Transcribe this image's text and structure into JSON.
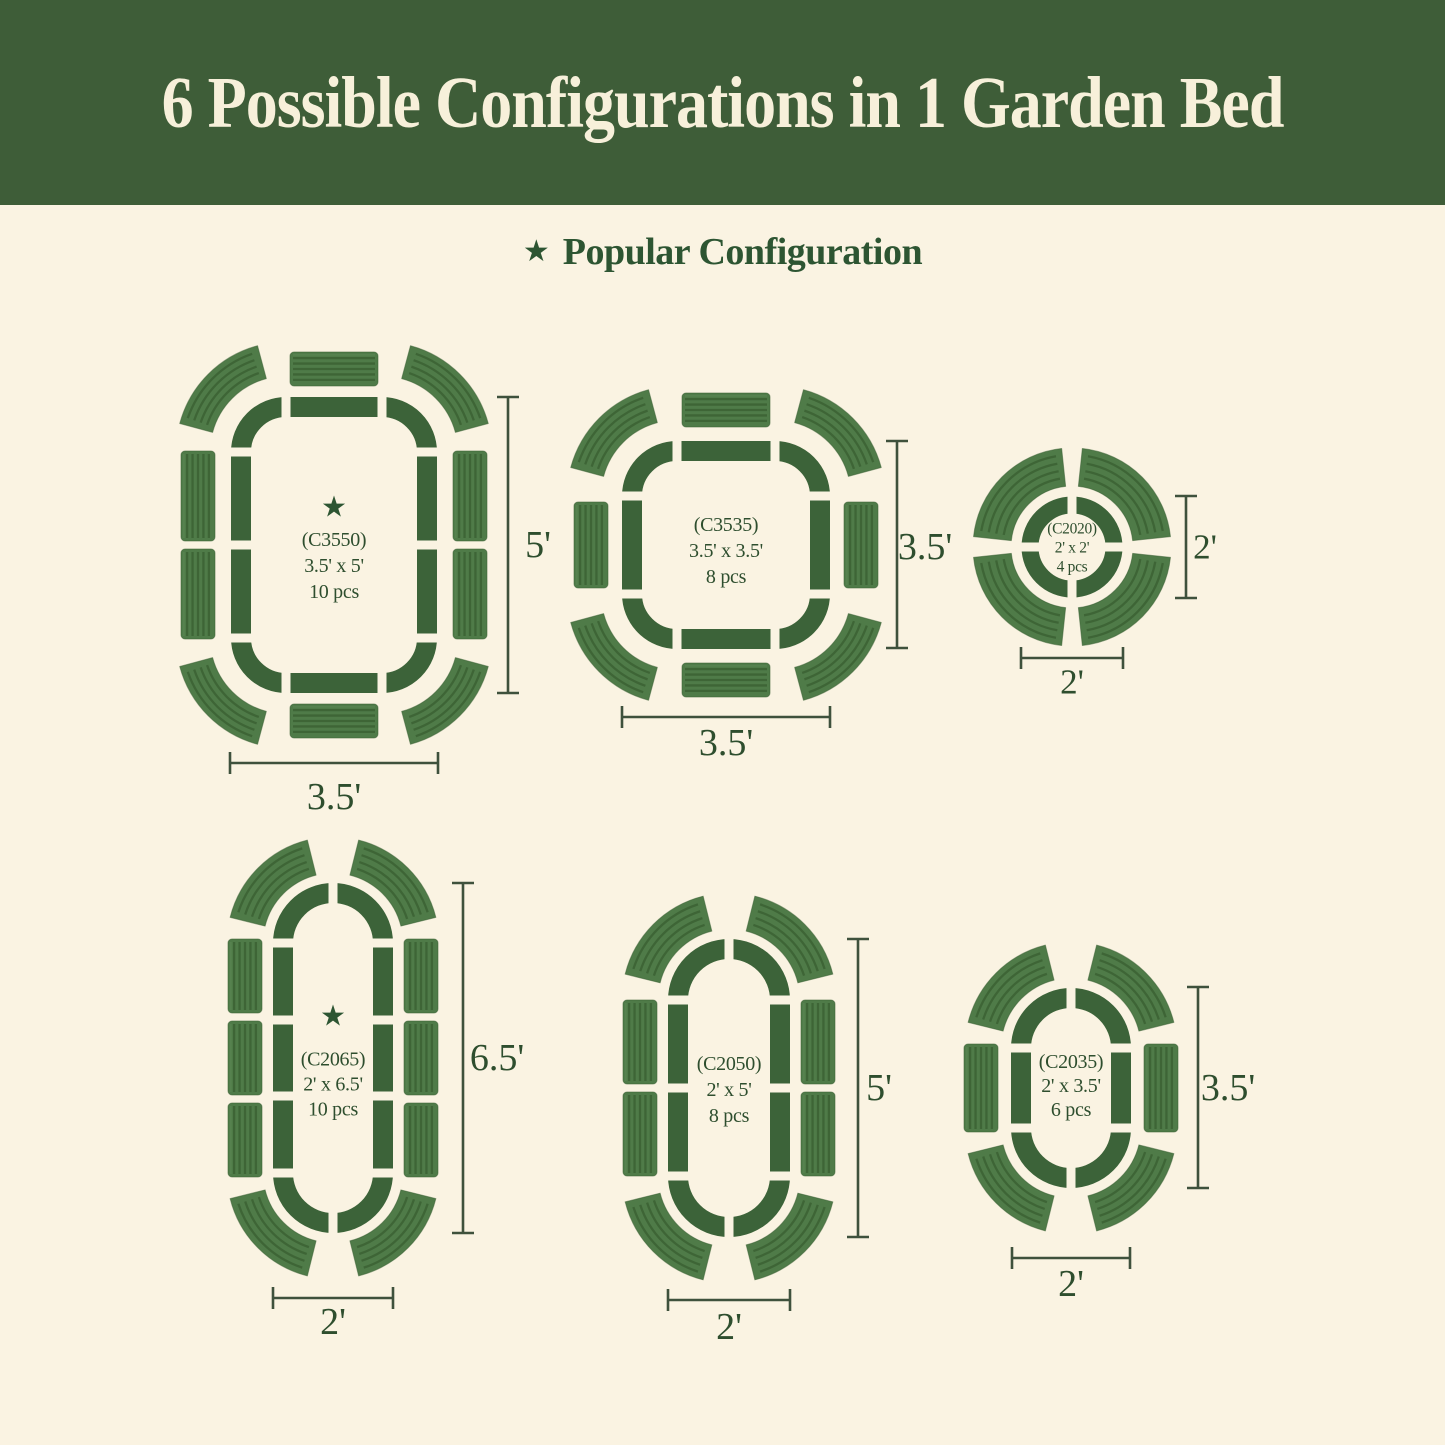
{
  "page": {
    "width": 1445,
    "height": 1445,
    "background": "#faf3e2"
  },
  "header": {
    "title": "6 Possible Configurations in 1 Garden Bed",
    "background": "#3e5d38",
    "text_color": "#f7f0da"
  },
  "legend": {
    "star": "★",
    "label": "Popular Configuration",
    "color": "#2d5532"
  },
  "colors": {
    "outline": "#3c6339",
    "panel_base": "#4f7b48",
    "panel_ridge": "#3b6134",
    "panel_highlight": "#578350",
    "dimension": "#3e513c",
    "label_text": "#2e4e2e"
  },
  "configs": [
    {
      "id": "C3550",
      "code": "(C3550)",
      "size": "3.5' x 5'",
      "pieces": "10 pcs",
      "popular": true,
      "dim_right": "5'",
      "dim_bottom": "3.5'"
    },
    {
      "id": "C3535",
      "code": "(C3535)",
      "size": "3.5' x 3.5'",
      "pieces": "8 pcs",
      "popular": false,
      "dim_right": "3.5'",
      "dim_bottom": "3.5'"
    },
    {
      "id": "C2020",
      "code": "(C2020)",
      "size": "2' x 2'",
      "pieces": "4 pcs",
      "popular": false,
      "dim_right": "2'",
      "dim_bottom": "2'"
    },
    {
      "id": "C2065",
      "code": "(C2065)",
      "size": "2' x 6.5'",
      "pieces": "10 pcs",
      "popular": true,
      "dim_right": "6.5'",
      "dim_bottom": "2'"
    },
    {
      "id": "C2050",
      "code": "(C2050)",
      "size": "2' x 5'",
      "pieces": "8 pcs",
      "popular": false,
      "dim_right": "5'",
      "dim_bottom": "2'"
    },
    {
      "id": "C2035",
      "code": "(C2035)",
      "size": "2' x 3.5'",
      "pieces": "6 pcs",
      "popular": false,
      "dim_right": "3.5'",
      "dim_bottom": "2'"
    }
  ]
}
